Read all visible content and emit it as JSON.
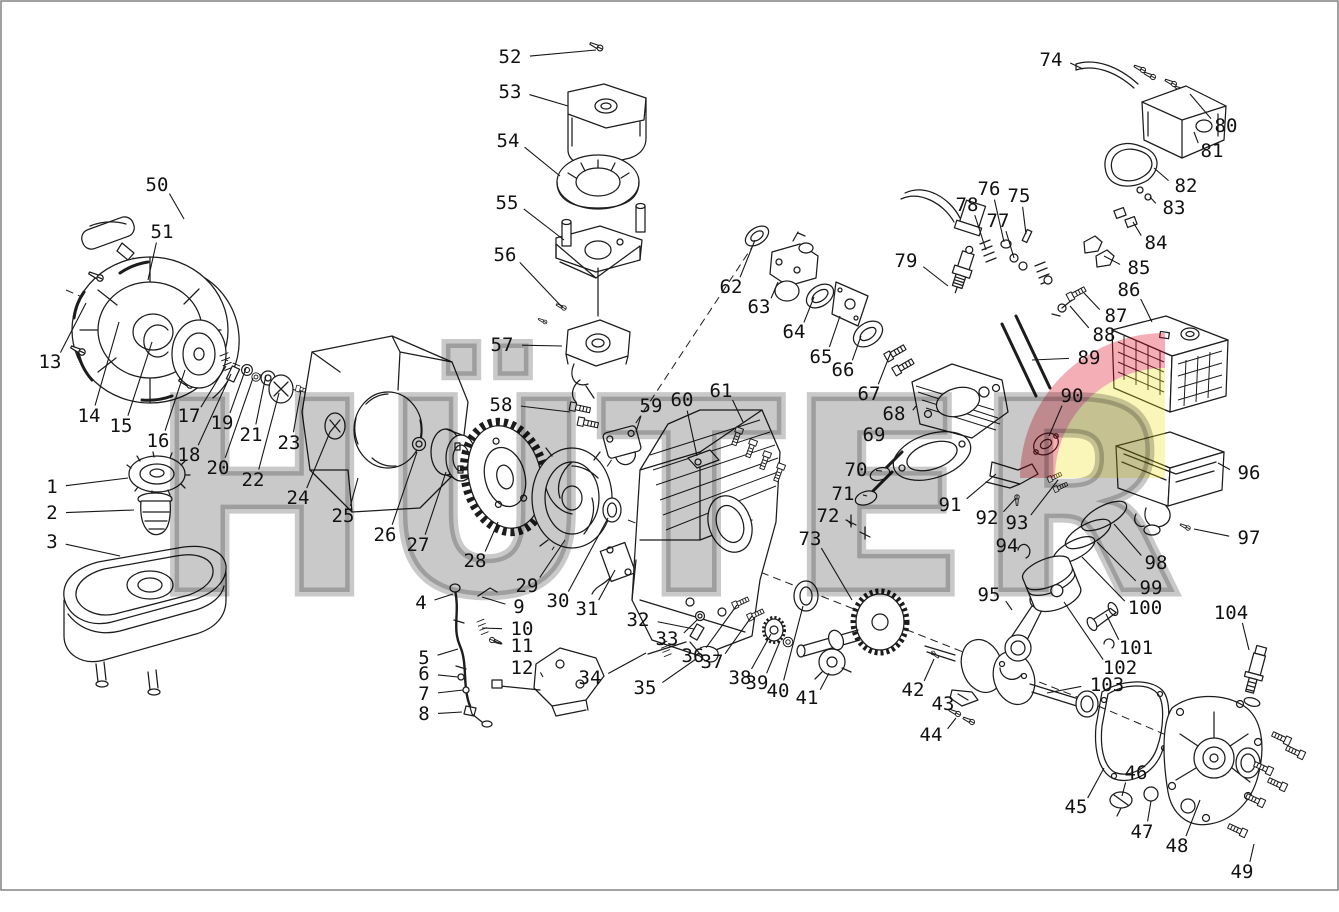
{
  "page": {
    "width": 1339,
    "height": 912,
    "background": "#ffffff",
    "border_color": "#8a8a8a"
  },
  "watermark": {
    "text": "HÜTER",
    "gray": "rgba(0,0,0,0.21)",
    "logo_red": "rgba(218,12,29,0.33)",
    "logo_yellow": "rgba(237,223,23,0.30)"
  },
  "diagram": {
    "description": "Exploded parts diagram of a HUTER single-cylinder gasoline engine",
    "part_count": 104
  },
  "labels": [
    {
      "n": "1",
      "x": 52,
      "y": 487,
      "tx": 128,
      "ty": 478
    },
    {
      "n": "2",
      "x": 52,
      "y": 513,
      "tx": 134,
      "ty": 510
    },
    {
      "n": "3",
      "x": 52,
      "y": 542,
      "tx": 120,
      "ty": 556
    },
    {
      "n": "4",
      "x": 421,
      "y": 603,
      "tx": 453,
      "ty": 594
    },
    {
      "n": "5",
      "x": 424,
      "y": 658,
      "tx": 458,
      "ty": 649
    },
    {
      "n": "6",
      "x": 424,
      "y": 674,
      "tx": 458,
      "ty": 677
    },
    {
      "n": "7",
      "x": 424,
      "y": 694,
      "tx": 463,
      "ty": 690
    },
    {
      "n": "8",
      "x": 424,
      "y": 714,
      "tx": 462,
      "ty": 712
    },
    {
      "n": "9",
      "x": 519,
      "y": 607,
      "tx": 482,
      "ty": 597
    },
    {
      "n": "10",
      "x": 522,
      "y": 629,
      "tx": 482,
      "ty": 628
    },
    {
      "n": "11",
      "x": 522,
      "y": 646,
      "tx": 494,
      "ty": 641
    },
    {
      "n": "12",
      "x": 522,
      "y": 668,
      "tx": 543,
      "ty": 677
    },
    {
      "n": "13",
      "x": 50,
      "y": 362,
      "tx": 86,
      "ty": 303
    },
    {
      "n": "14",
      "x": 89,
      "y": 416,
      "tx": 119,
      "ty": 322
    },
    {
      "n": "15",
      "x": 121,
      "y": 426,
      "tx": 152,
      "ty": 342
    },
    {
      "n": "16",
      "x": 158,
      "y": 441,
      "tx": 185,
      "ty": 370
    },
    {
      "n": "17",
      "x": 189,
      "y": 416,
      "tx": 226,
      "ty": 366
    },
    {
      "n": "18",
      "x": 189,
      "y": 455,
      "tx": 231,
      "ty": 374
    },
    {
      "n": "19",
      "x": 222,
      "y": 423,
      "tx": 246,
      "ty": 368
    },
    {
      "n": "20",
      "x": 218,
      "y": 468,
      "tx": 253,
      "ty": 378
    },
    {
      "n": "21",
      "x": 251,
      "y": 435,
      "tx": 266,
      "ty": 375
    },
    {
      "n": "22",
      "x": 253,
      "y": 480,
      "tx": 279,
      "ty": 393
    },
    {
      "n": "23",
      "x": 289,
      "y": 443,
      "tx": 301,
      "ty": 390
    },
    {
      "n": "24",
      "x": 298,
      "y": 498,
      "tx": 330,
      "ty": 432
    },
    {
      "n": "25",
      "x": 343,
      "y": 516,
      "tx": 358,
      "ty": 478
    },
    {
      "n": "26",
      "x": 385,
      "y": 535,
      "tx": 417,
      "ty": 452
    },
    {
      "n": "27",
      "x": 418,
      "y": 545,
      "tx": 446,
      "ty": 472
    },
    {
      "n": "28",
      "x": 475,
      "y": 561,
      "tx": 498,
      "ty": 522
    },
    {
      "n": "29",
      "x": 527,
      "y": 586,
      "tx": 565,
      "ty": 540
    },
    {
      "n": "30",
      "x": 558,
      "y": 601,
      "tx": 608,
      "ty": 518
    },
    {
      "n": "31",
      "x": 587,
      "y": 609,
      "tx": 615,
      "ty": 570
    },
    {
      "n": "32",
      "x": 638,
      "y": 620,
      "tx": 694,
      "ty": 629
    },
    {
      "n": "33",
      "x": 667,
      "y": 639,
      "tx": 698,
      "ty": 619
    },
    {
      "n": "34",
      "x": 590,
      "y": 678,
      "tx": 646,
      "ty": 653
    },
    {
      "n": "35",
      "x": 645,
      "y": 688,
      "tx": 696,
      "ty": 659
    },
    {
      "n": "36",
      "x": 693,
      "y": 656,
      "tx": 737,
      "ty": 605
    },
    {
      "n": "37",
      "x": 712,
      "y": 662,
      "tx": 752,
      "ty": 616
    },
    {
      "n": "38",
      "x": 740,
      "y": 678,
      "tx": 771,
      "ty": 634
    },
    {
      "n": "39",
      "x": 757,
      "y": 683,
      "tx": 780,
      "ty": 641
    },
    {
      "n": "40",
      "x": 778,
      "y": 691,
      "tx": 803,
      "ty": 606
    },
    {
      "n": "41",
      "x": 807,
      "y": 698,
      "tx": 829,
      "ty": 673
    },
    {
      "n": "42",
      "x": 913,
      "y": 690,
      "tx": 934,
      "ty": 659
    },
    {
      "n": "43",
      "x": 943,
      "y": 704,
      "tx": 955,
      "ty": 696
    },
    {
      "n": "44",
      "x": 931,
      "y": 735,
      "tx": 956,
      "ty": 718
    },
    {
      "n": "45",
      "x": 1076,
      "y": 807,
      "tx": 1104,
      "ty": 768
    },
    {
      "n": "46",
      "x": 1136,
      "y": 773,
      "tx": 1122,
      "ty": 796
    },
    {
      "n": "47",
      "x": 1142,
      "y": 832,
      "tx": 1151,
      "ty": 801
    },
    {
      "n": "48",
      "x": 1177,
      "y": 846,
      "tx": 1200,
      "ty": 800
    },
    {
      "n": "49",
      "x": 1242,
      "y": 872,
      "tx": 1254,
      "ty": 844
    },
    {
      "n": "50",
      "x": 157,
      "y": 185,
      "tx": 184,
      "ty": 219
    },
    {
      "n": "51",
      "x": 162,
      "y": 232,
      "tx": 148,
      "ty": 280
    },
    {
      "n": "52",
      "x": 510,
      "y": 57,
      "tx": 596,
      "ty": 50
    },
    {
      "n": "53",
      "x": 510,
      "y": 92,
      "tx": 568,
      "ty": 106
    },
    {
      "n": "54",
      "x": 508,
      "y": 141,
      "tx": 560,
      "ty": 176
    },
    {
      "n": "55",
      "x": 507,
      "y": 203,
      "tx": 564,
      "ty": 240
    },
    {
      "n": "56",
      "x": 505,
      "y": 255,
      "tx": 562,
      "ty": 307
    },
    {
      "n": "57",
      "x": 502,
      "y": 345,
      "tx": 562,
      "ty": 346
    },
    {
      "n": "58",
      "x": 501,
      "y": 405,
      "tx": 570,
      "ty": 412
    },
    {
      "n": "59",
      "x": 651,
      "y": 406,
      "tx": 636,
      "ty": 432
    },
    {
      "n": "60",
      "x": 682,
      "y": 400,
      "tx": 697,
      "ty": 456
    },
    {
      "n": "61",
      "x": 721,
      "y": 391,
      "tx": 743,
      "ty": 422
    },
    {
      "n": "62",
      "x": 731,
      "y": 287,
      "tx": 755,
      "ty": 240
    },
    {
      "n": "63",
      "x": 759,
      "y": 307,
      "tx": 778,
      "ty": 282
    },
    {
      "n": "64",
      "x": 794,
      "y": 332,
      "tx": 814,
      "ty": 297
    },
    {
      "n": "65",
      "x": 821,
      "y": 357,
      "tx": 840,
      "ty": 316
    },
    {
      "n": "66",
      "x": 843,
      "y": 370,
      "tx": 861,
      "ty": 336
    },
    {
      "n": "67",
      "x": 869,
      "y": 394,
      "tx": 891,
      "ty": 352
    },
    {
      "n": "68",
      "x": 894,
      "y": 414,
      "tx": 916,
      "ty": 406
    },
    {
      "n": "69",
      "x": 874,
      "y": 435,
      "tx": 890,
      "ty": 446
    },
    {
      "n": "70",
      "x": 856,
      "y": 470,
      "tx": 882,
      "ty": 471
    },
    {
      "n": "71",
      "x": 843,
      "y": 494,
      "tx": 867,
      "ty": 496
    },
    {
      "n": "72",
      "x": 828,
      "y": 516,
      "tx": 852,
      "ty": 525
    },
    {
      "n": "73",
      "x": 810,
      "y": 539,
      "tx": 852,
      "ty": 600
    },
    {
      "n": "74",
      "x": 1051,
      "y": 60,
      "tx": 1083,
      "ty": 69
    },
    {
      "n": "75",
      "x": 1019,
      "y": 196,
      "tx": 1026,
      "ty": 234
    },
    {
      "n": "76",
      "x": 989,
      "y": 189,
      "tx": 1004,
      "ty": 242
    },
    {
      "n": "77",
      "x": 998,
      "y": 221,
      "tx": 1014,
      "ty": 258
    },
    {
      "n": "78",
      "x": 967,
      "y": 205,
      "tx": 986,
      "ty": 250
    },
    {
      "n": "79",
      "x": 906,
      "y": 261,
      "tx": 948,
      "ty": 286
    },
    {
      "n": "80",
      "x": 1226,
      "y": 126,
      "tx": 1190,
      "ty": 94
    },
    {
      "n": "81",
      "x": 1212,
      "y": 151,
      "tx": 1194,
      "ty": 132
    },
    {
      "n": "82",
      "x": 1186,
      "y": 186,
      "tx": 1154,
      "ty": 168
    },
    {
      "n": "83",
      "x": 1174,
      "y": 208,
      "tx": 1150,
      "ty": 197
    },
    {
      "n": "84",
      "x": 1156,
      "y": 243,
      "tx": 1133,
      "ty": 222
    },
    {
      "n": "85",
      "x": 1139,
      "y": 268,
      "tx": 1104,
      "ty": 256
    },
    {
      "n": "86",
      "x": 1129,
      "y": 290,
      "tx": 1152,
      "ty": 322
    },
    {
      "n": "87",
      "x": 1116,
      "y": 316,
      "tx": 1084,
      "ty": 293
    },
    {
      "n": "88",
      "x": 1104,
      "y": 335,
      "tx": 1070,
      "ty": 306
    },
    {
      "n": "89",
      "x": 1089,
      "y": 358,
      "tx": 1032,
      "ty": 360
    },
    {
      "n": "90",
      "x": 1072,
      "y": 396,
      "tx": 1049,
      "ty": 436
    },
    {
      "n": "91",
      "x": 950,
      "y": 505,
      "tx": 996,
      "ty": 474
    },
    {
      "n": "92",
      "x": 987,
      "y": 518,
      "tx": 1016,
      "ty": 498
    },
    {
      "n": "93",
      "x": 1017,
      "y": 523,
      "tx": 1058,
      "ty": 480
    },
    {
      "n": "94",
      "x": 1007,
      "y": 546,
      "tx": 1022,
      "ty": 553
    },
    {
      "n": "95",
      "x": 989,
      "y": 595,
      "tx": 1012,
      "ty": 610
    },
    {
      "n": "96",
      "x": 1249,
      "y": 473,
      "tx": 1218,
      "ty": 463
    },
    {
      "n": "97",
      "x": 1249,
      "y": 538,
      "tx": 1194,
      "ty": 529
    },
    {
      "n": "98",
      "x": 1156,
      "y": 563,
      "tx": 1114,
      "ty": 524
    },
    {
      "n": "99",
      "x": 1151,
      "y": 588,
      "tx": 1097,
      "ty": 542
    },
    {
      "n": "100",
      "x": 1145,
      "y": 608,
      "tx": 1082,
      "ty": 557
    },
    {
      "n": "101",
      "x": 1136,
      "y": 648,
      "tx": 1106,
      "ty": 614
    },
    {
      "n": "102",
      "x": 1120,
      "y": 668,
      "tx": 1064,
      "ty": 602
    },
    {
      "n": "103",
      "x": 1107,
      "y": 685,
      "tx": 1047,
      "ty": 693
    },
    {
      "n": "104",
      "x": 1231,
      "y": 613,
      "tx": 1249,
      "ty": 650
    }
  ]
}
